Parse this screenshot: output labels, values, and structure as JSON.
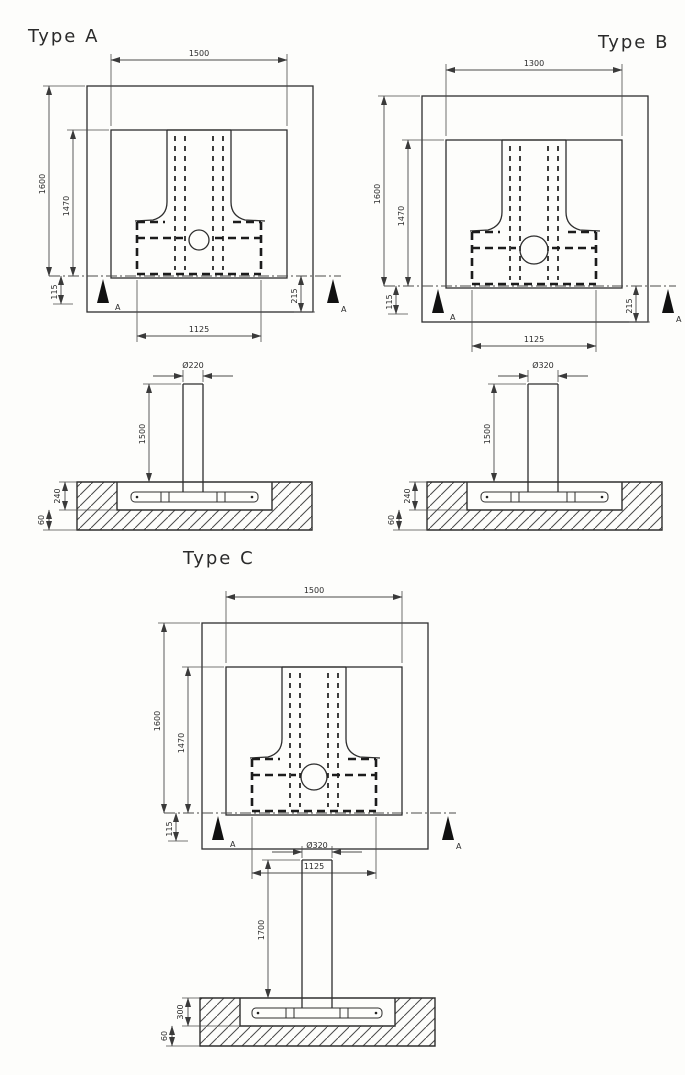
{
  "figures": {
    "type_a": {
      "title": "Type A",
      "plan": {
        "top_width": "1500",
        "outer_height": "1600",
        "inner_height": "1470",
        "bottom_width": "1125",
        "left_offset": "115",
        "right_offset": "215",
        "section_label": "A"
      },
      "section": {
        "pole_diameter": "Ø220",
        "pole_height": "1500",
        "embed_depth": "240",
        "toe_depth": "60"
      }
    },
    "type_b": {
      "title": "Type B",
      "plan": {
        "top_width": "1300",
        "outer_height": "1600",
        "inner_height": "1470",
        "bottom_width": "1125",
        "left_offset": "115",
        "right_offset": "215",
        "section_label": "A"
      },
      "section": {
        "pole_diameter": "Ø320",
        "pole_height": "1500",
        "embed_depth": "240",
        "toe_depth": "60"
      }
    },
    "type_c": {
      "title": "Type C",
      "plan": {
        "top_width": "1500",
        "outer_height": "1600",
        "inner_height": "1470",
        "bottom_width": "1125",
        "left_offset": "115",
        "section_label": "A"
      },
      "section": {
        "pole_diameter": "Ø320",
        "pole_height": "1700",
        "embed_depth": "300",
        "toe_depth": "60"
      }
    }
  }
}
